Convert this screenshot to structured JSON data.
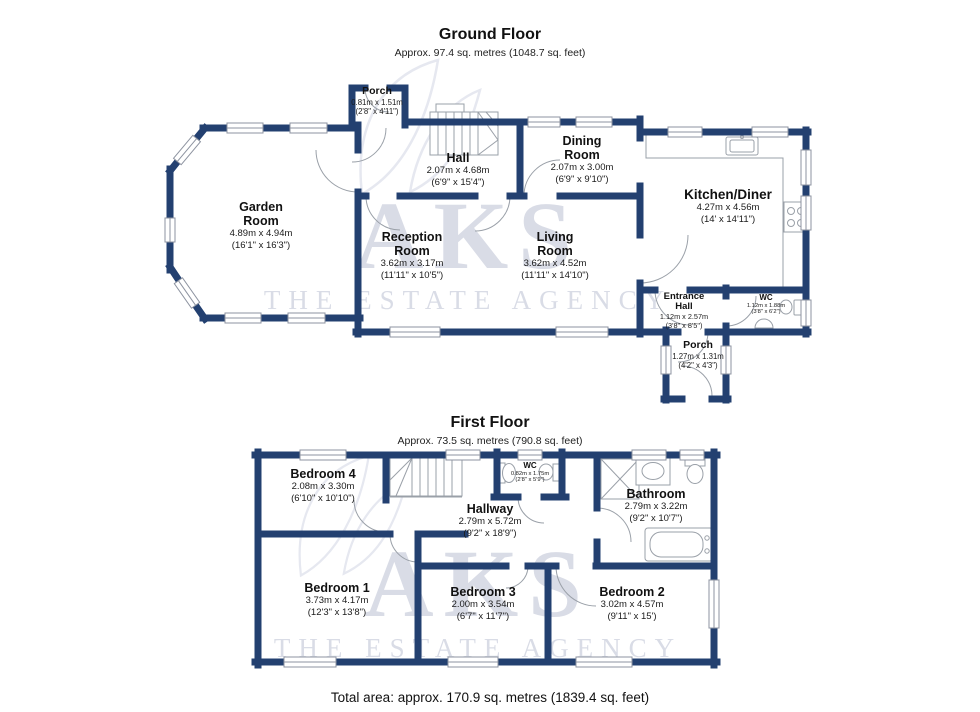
{
  "ground_floor": {
    "title": "Ground Floor",
    "subtitle": "Approx. 97.4 sq. metres (1048.7 sq. feet)",
    "rooms": {
      "porch_front": {
        "name": "Porch",
        "metric": "0.81m x 1.51m",
        "imperial": "(2'8\" x 4'11\")"
      },
      "hall": {
        "name": "Hall",
        "metric": "2.07m x 4.68m",
        "imperial": "(6'9\" x 15'4\")"
      },
      "dining": {
        "name": "Dining\nRoom",
        "metric": "2.07m x 3.00m",
        "imperial": "(6'9\" x 9'10\")"
      },
      "kitchen": {
        "name": "Kitchen/Diner",
        "metric": "4.27m x 4.56m",
        "imperial": "(14' x 14'11\")"
      },
      "garden": {
        "name": "Garden\nRoom",
        "metric": "4.89m x 4.94m",
        "imperial": "(16'1\" x 16'3\")"
      },
      "reception": {
        "name": "Reception\nRoom",
        "metric": "3.62m x 3.17m",
        "imperial": "(11'11\" x 10'5\")"
      },
      "living": {
        "name": "Living\nRoom",
        "metric": "3.62m x 4.52m",
        "imperial": "(11'11\" x 14'10\")"
      },
      "entrance": {
        "name": "Entrance\nHall",
        "metric": "1.12m x 2.57m",
        "imperial": "(3'8\" x 8'5\")"
      },
      "wc": {
        "name": "WC",
        "metric": "1.12m x 1.88m",
        "imperial": "(3'8\" x 6'2\")"
      },
      "porch_rear": {
        "name": "Porch",
        "metric": "1.27m x 1.31m",
        "imperial": "(4'2\" x 4'3\")"
      }
    }
  },
  "first_floor": {
    "title": "First Floor",
    "subtitle": "Approx. 73.5 sq. metres (790.8 sq. feet)",
    "rooms": {
      "bedroom4": {
        "name": "Bedroom 4",
        "metric": "2.08m x 3.30m",
        "imperial": "(6'10\" x 10'10\")"
      },
      "hallway": {
        "name": "Hallway",
        "metric": "2.79m x 5.72m",
        "imperial": "(9'2\" x 18'9\")"
      },
      "wc": {
        "name": "WC",
        "metric": "0.82m x 1.75m",
        "imperial": "(2'8\" x 5'9\")"
      },
      "bathroom": {
        "name": "Bathroom",
        "metric": "2.79m x 3.22m",
        "imperial": "(9'2\" x 10'7\")"
      },
      "bedroom1": {
        "name": "Bedroom 1",
        "metric": "3.73m x 4.17m",
        "imperial": "(12'3\" x 13'8\")"
      },
      "bedroom3": {
        "name": "Bedroom 3",
        "metric": "2.00m x 3.54m",
        "imperial": "(6'7\" x 11'7\")"
      },
      "bedroom2": {
        "name": "Bedroom 2",
        "metric": "3.02m x 4.57m",
        "imperial": "(9'11\" x 15')"
      }
    }
  },
  "footer": {
    "total_area": "Total area: approx. 170.9 sq. metres (1839.4 sq. feet)"
  },
  "watermark": {
    "brand": "AKS",
    "tagline": "THE ESTATE AGENCY"
  },
  "colors": {
    "wall": "#234070",
    "fixture_line": "#9aa0a8",
    "watermark": "#d9dce6",
    "text": "#111111"
  }
}
